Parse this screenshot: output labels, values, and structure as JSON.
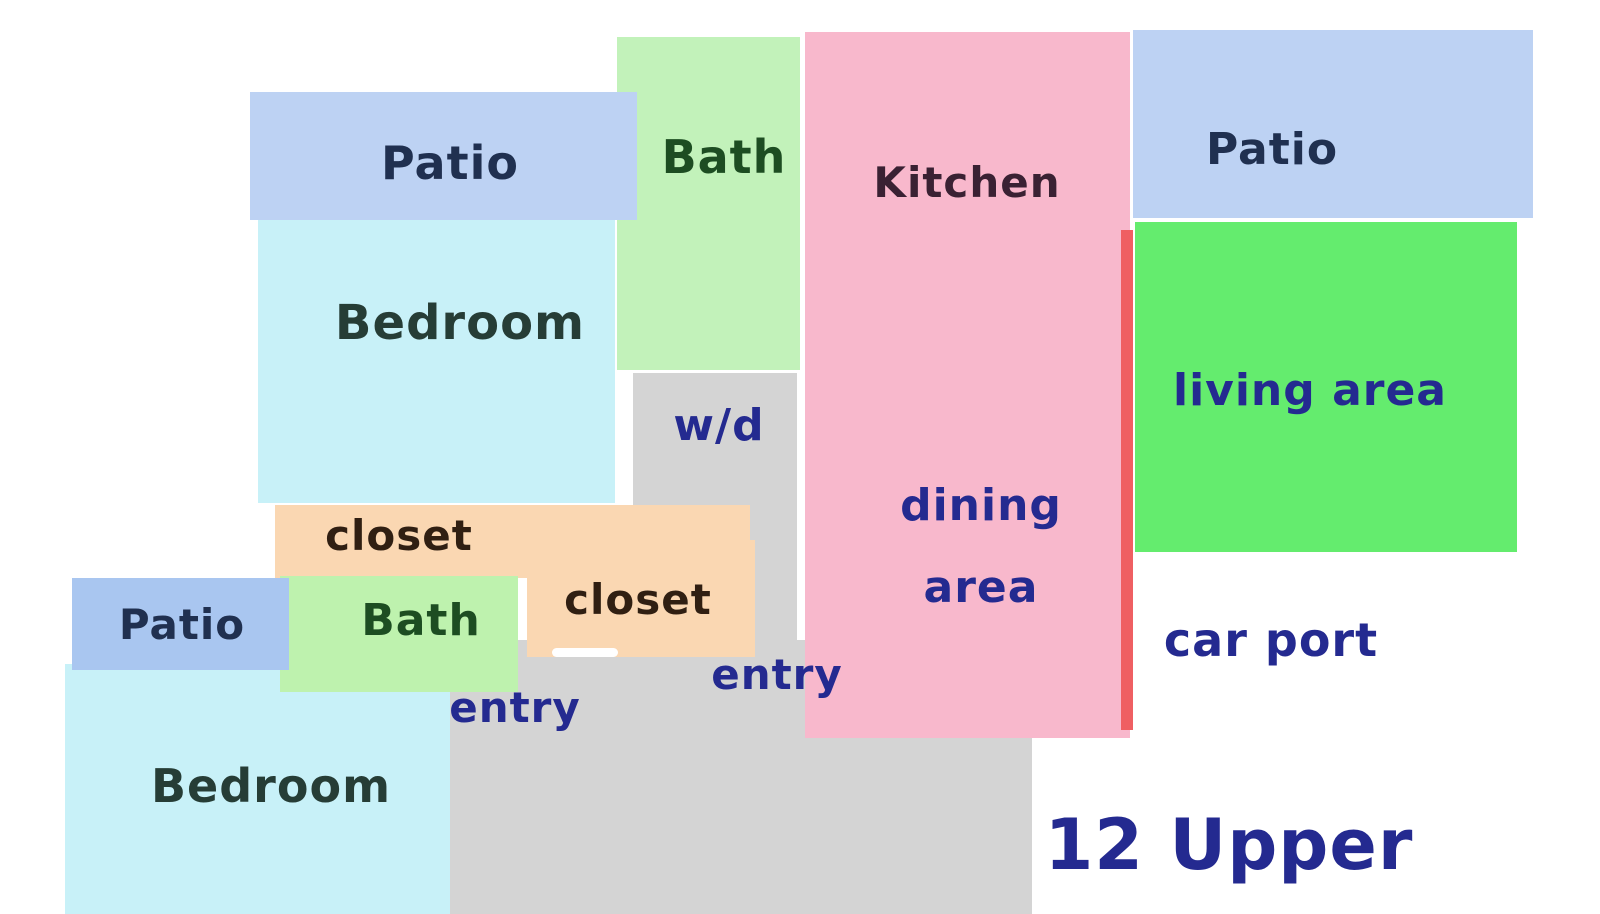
{
  "plan_title": "12 Upper",
  "colors": {
    "background": "#ffffff",
    "patio_blue": "#bdd2f3",
    "patio_blue_lower": "#a9c6f0",
    "bedroom_cyan": "#c8f1f8",
    "bath_green_pale": "#c2f2ba",
    "bath_green_lower": "#bef2ae",
    "kitchen_pink": "#f8b8cc",
    "living_green": "#64ec6e",
    "closet_peach": "#fad7b2",
    "entry_gray": "#d4d4d4",
    "divider_red": "#ef5f62",
    "label_navy": "#242a90",
    "label_dark_blue": "#203050",
    "label_dark_green": "#1d4d22",
    "label_dark_slate": "#263d36",
    "label_dark_brown": "#301f12",
    "label_dark_plum": "#3a2133"
  },
  "boxes": [
    {
      "name": "bath-top-room",
      "fill": "#c2f2ba",
      "x": 617,
      "y": 37,
      "w": 183,
      "h": 333,
      "radius": 0
    },
    {
      "name": "patio-top-left-room",
      "fill": "#bdd2f3",
      "x": 250,
      "y": 92,
      "w": 387,
      "h": 128,
      "radius": 0
    },
    {
      "name": "bedroom-top-room",
      "fill": "#c8f1f8",
      "x": 258,
      "y": 220,
      "w": 357,
      "h": 283,
      "radius": 0
    },
    {
      "name": "wd-column",
      "fill": "#d4d4d4",
      "x": 633,
      "y": 373,
      "w": 164,
      "h": 270,
      "radius": 0
    },
    {
      "name": "entry-block",
      "fill": "#d4d4d4",
      "x": 450,
      "y": 640,
      "w": 582,
      "h": 274,
      "radius": 0
    },
    {
      "name": "kitchen-dining-room",
      "fill": "#f8b8cc",
      "x": 805,
      "y": 32,
      "w": 325,
      "h": 706,
      "radius": 0
    },
    {
      "name": "divider-line",
      "fill": "#ef5f62",
      "x": 1121,
      "y": 230,
      "w": 12,
      "h": 500,
      "radius": 0
    },
    {
      "name": "patio-top-right-room",
      "fill": "#bdd2f3",
      "x": 1133,
      "y": 30,
      "w": 400,
      "h": 188,
      "radius": 0
    },
    {
      "name": "living-area-room",
      "fill": "#64ec6e",
      "x": 1135,
      "y": 222,
      "w": 382,
      "h": 330,
      "radius": 0
    },
    {
      "name": "closet-1-room",
      "fill": "#fad7b2",
      "x": 275,
      "y": 505,
      "w": 475,
      "h": 73,
      "radius": 0
    },
    {
      "name": "closet-2-room",
      "fill": "#fad7b2",
      "x": 527,
      "y": 540,
      "w": 228,
      "h": 117,
      "radius": 0
    },
    {
      "name": "bedroom-bottom-room",
      "fill": "#c8f1f8",
      "x": 65,
      "y": 664,
      "w": 385,
      "h": 250,
      "radius": 0
    },
    {
      "name": "bath-lower-room",
      "fill": "#bef2ae",
      "x": 280,
      "y": 576,
      "w": 238,
      "h": 116,
      "radius": 0
    },
    {
      "name": "patio-lower-left-room",
      "fill": "#a9c6f0",
      "x": 72,
      "y": 578,
      "w": 217,
      "h": 92,
      "radius": 0
    },
    {
      "name": "white-streak",
      "fill": "#ffffff",
      "x": 552,
      "y": 648,
      "w": 66,
      "h": 9,
      "radius": 5
    }
  ],
  "labels": [
    {
      "name": "patio-top-left-label",
      "text": "Patio",
      "x": 450,
      "y": 163,
      "size": 46,
      "color": "#203050"
    },
    {
      "name": "bath-top-label",
      "text": "Bath",
      "x": 724,
      "y": 157,
      "size": 46,
      "color": "#1d4d22"
    },
    {
      "name": "kitchen-label",
      "text": "Kitchen",
      "x": 967,
      "y": 183,
      "size": 42,
      "color": "#3a2133"
    },
    {
      "name": "patio-top-right-label",
      "text": "Patio",
      "x": 1272,
      "y": 150,
      "size": 44,
      "color": "#203050"
    },
    {
      "name": "bedroom-top-label",
      "text": "Bedroom",
      "x": 460,
      "y": 323,
      "size": 48,
      "color": "#263d36"
    },
    {
      "name": "wd-label",
      "text": "w/d",
      "x": 719,
      "y": 426,
      "size": 44,
      "color": "#242a90"
    },
    {
      "name": "dining-label",
      "text": "dining",
      "x": 981,
      "y": 506,
      "size": 44,
      "color": "#242a90"
    },
    {
      "name": "dining-area-label",
      "text": "area",
      "x": 981,
      "y": 588,
      "size": 44,
      "color": "#242a90"
    },
    {
      "name": "living-area-label",
      "text": "living area",
      "x": 1310,
      "y": 391,
      "size": 44,
      "color": "#242a90"
    },
    {
      "name": "closet-1-label",
      "text": "closet",
      "x": 399,
      "y": 536,
      "size": 42,
      "color": "#301f12"
    },
    {
      "name": "closet-2-label",
      "text": "closet",
      "x": 638,
      "y": 600,
      "size": 42,
      "color": "#301f12"
    },
    {
      "name": "bath-lower-label",
      "text": "Bath",
      "x": 421,
      "y": 621,
      "size": 44,
      "color": "#1d4d22"
    },
    {
      "name": "patio-lower-left-label",
      "text": "Patio",
      "x": 182,
      "y": 625,
      "size": 42,
      "color": "#203050"
    },
    {
      "name": "entry-1-label",
      "text": "entry",
      "x": 515,
      "y": 708,
      "size": 42,
      "color": "#242a90"
    },
    {
      "name": "entry-2-label",
      "text": "entry",
      "x": 777,
      "y": 675,
      "size": 42,
      "color": "#242a90"
    },
    {
      "name": "bedroom-bottom-label",
      "text": "Bedroom",
      "x": 271,
      "y": 786,
      "size": 46,
      "color": "#263d36"
    },
    {
      "name": "car-port-label",
      "text": "car port",
      "x": 1271,
      "y": 640,
      "size": 46,
      "color": "#242a90"
    },
    {
      "name": "floor-title",
      "text": "12 Upper",
      "x": 1229,
      "y": 845,
      "size": 70,
      "color": "#242a90"
    }
  ]
}
